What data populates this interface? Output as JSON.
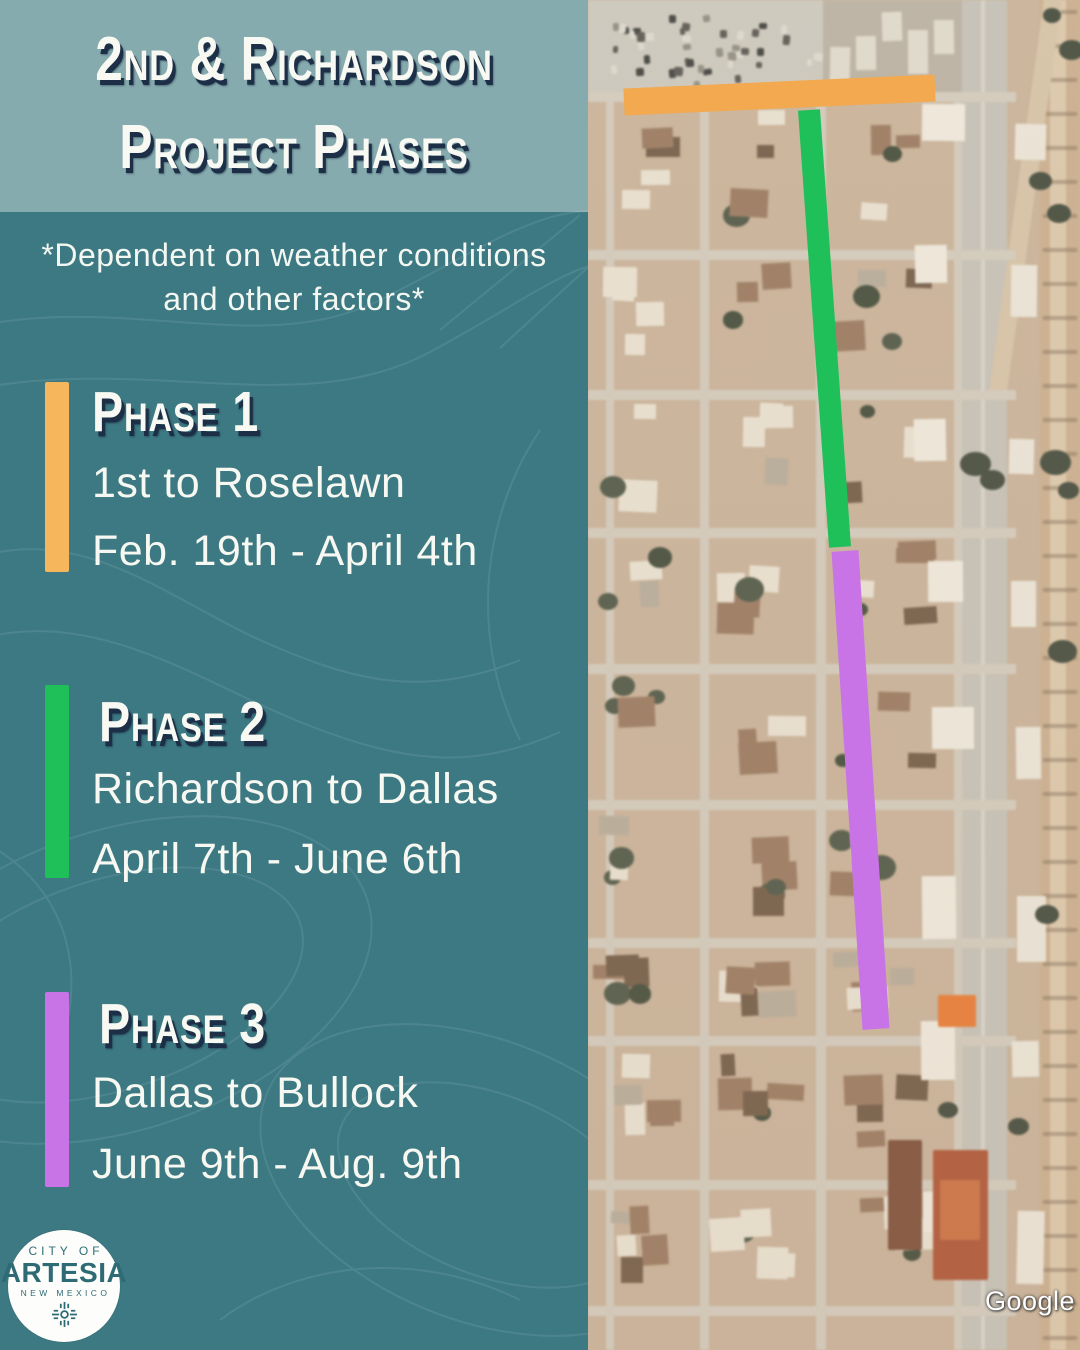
{
  "poster": {
    "title_line1": "2nd & Richardson",
    "title_line2": "Project Phases",
    "disclaimer_line1": "*Dependent on weather conditions",
    "disclaimer_line2": "and other factors*"
  },
  "phases": [
    {
      "name": "Phase 1",
      "segment": "1st to Roselawn",
      "dates": "Feb. 19th - April 4th",
      "color": "#f6b75c"
    },
    {
      "name": "Phase 2",
      "segment": "Richardson to Dallas",
      "dates": "April 7th - June 6th",
      "color": "#1fc05a"
    },
    {
      "name": "Phase 3",
      "segment": "Dallas to Bullock",
      "dates": "June 9th - Aug. 9th",
      "color": "#c874e6"
    }
  ],
  "map": {
    "attribution": "Google",
    "route_overlays": [
      {
        "phase": "Phase 1",
        "orientation": "horizontal",
        "color": "#f2a94f"
      },
      {
        "phase": "Phase 2",
        "orientation": "vertical",
        "color": "#1fc05a"
      },
      {
        "phase": "Phase 3",
        "orientation": "vertical",
        "color": "#c874e6"
      }
    ]
  },
  "logo": {
    "top": "CITY OF",
    "name": "ARTESIA",
    "subtitle": "NEW MEXICO"
  },
  "colors": {
    "panel_bg": "#3d7983",
    "header_band": "#86abaf",
    "text": "#f6f8f1",
    "heading_shadow": "#1c2f47",
    "logo_text": "#2e6b75"
  }
}
